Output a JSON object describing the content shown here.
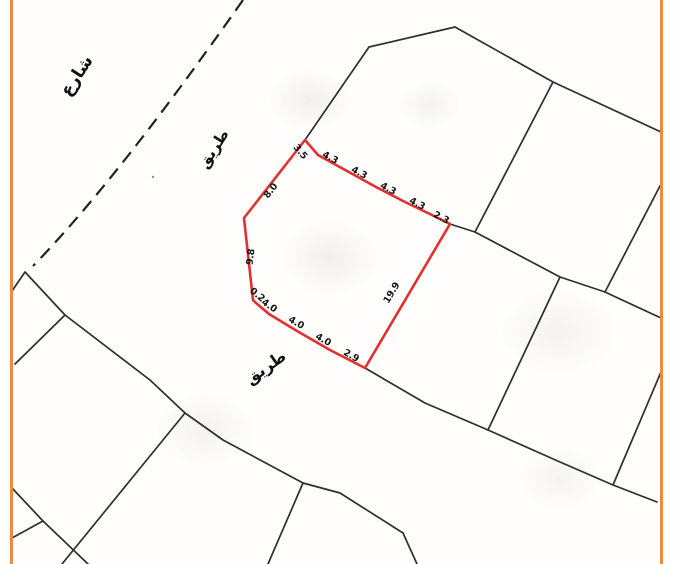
{
  "document": {
    "type": "cadastral-survey-sheet"
  },
  "frame": {
    "color": "#EE8A3B"
  },
  "boundaries": {
    "color": "#2E2E2E"
  },
  "street_labels": [
    {
      "text": "شارع",
      "x": 77,
      "y": 76,
      "rot": -57,
      "size": 17
    },
    {
      "text": "طريق",
      "x": 214,
      "y": 149,
      "rot": -57,
      "size": 15
    },
    {
      "text": "طريق",
      "x": 266,
      "y": 368,
      "rot": -35,
      "size": 16
    }
  ],
  "parcel": {
    "outline_color": "#E0312F",
    "dimension_labels": [
      {
        "value": "3.5",
        "x": 300,
        "y": 152,
        "rot": 50
      },
      {
        "value": "4.3",
        "x": 330,
        "y": 158,
        "rot": 28
      },
      {
        "value": "4.3",
        "x": 359,
        "y": 173,
        "rot": 28
      },
      {
        "value": "4.3",
        "x": 388,
        "y": 189,
        "rot": 28
      },
      {
        "value": "4.3",
        "x": 417,
        "y": 204,
        "rot": 28
      },
      {
        "value": "2.3",
        "x": 441,
        "y": 218,
        "rot": 28
      },
      {
        "value": "19.9",
        "x": 392,
        "y": 293,
        "rot": -59
      },
      {
        "value": "2.9",
        "x": 351,
        "y": 356,
        "rot": 30
      },
      {
        "value": "4.0",
        "x": 323,
        "y": 340,
        "rot": 30
      },
      {
        "value": "4.0",
        "x": 296,
        "y": 323,
        "rot": 30
      },
      {
        "value": "4.0",
        "x": 269,
        "y": 306,
        "rot": 35
      },
      {
        "value": "0.2",
        "x": 257,
        "y": 295,
        "rot": 40
      },
      {
        "value": "9.8",
        "x": 251,
        "y": 257,
        "rot": -83
      },
      {
        "value": "8.0",
        "x": 271,
        "y": 191,
        "rot": -52
      }
    ],
    "dimensions_summary": {
      "top": [
        "3.5",
        "4.3",
        "4.3",
        "4.3",
        "4.3",
        "2.3"
      ],
      "right": [
        "19.9"
      ],
      "bottom": [
        "2.9",
        "4.0",
        "4.0",
        "4.0",
        "0.2"
      ],
      "left": [
        "9.8",
        "8.0"
      ]
    }
  }
}
